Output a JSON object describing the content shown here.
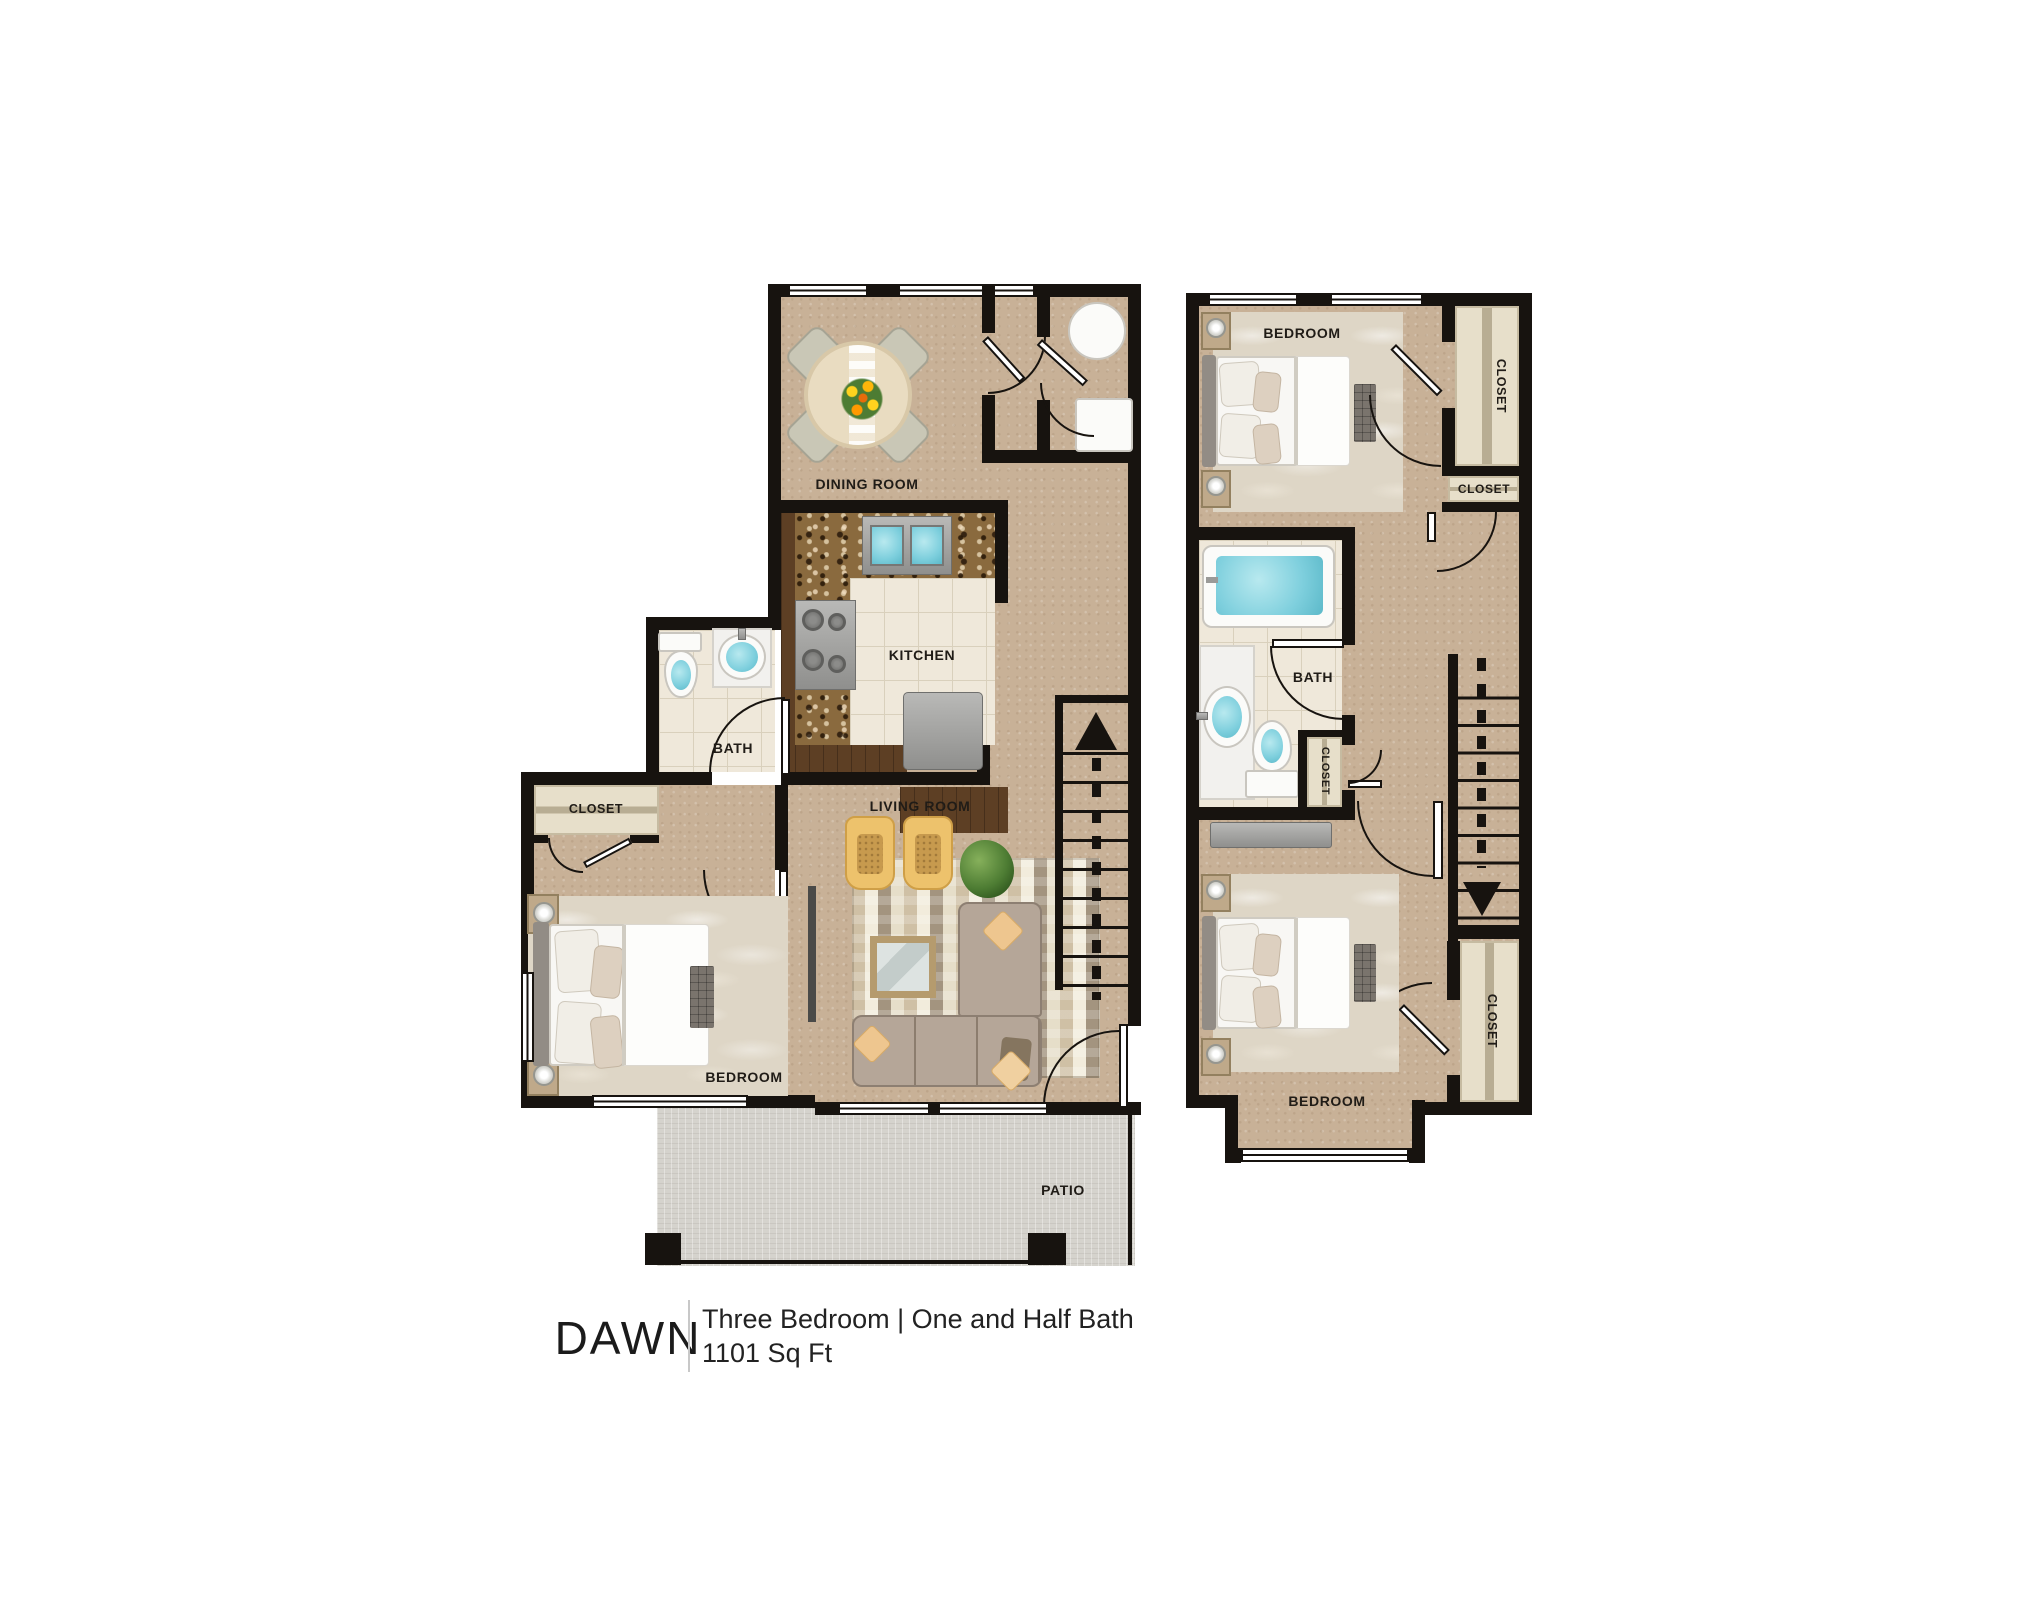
{
  "footer": {
    "name": "DAWN",
    "description": "Three Bedroom | One and Half Bath",
    "area": "1101 Sq Ft"
  },
  "floor1": {
    "dining_room": "DINING ROOM",
    "kitchen": "KITCHEN",
    "bath": "BATH",
    "closet": "CLOSET",
    "bedroom": "BEDROOM",
    "living_room": "LIVING ROOM",
    "patio": "PATIO"
  },
  "floor2": {
    "bedroom_top": "BEDROOM",
    "closet_top": "CLOSET",
    "closet_mid": "CLOSET",
    "bath": "BATH",
    "closet_bath": "CLOSET",
    "bedroom_bottom": "BEDROOM",
    "closet_bottom": "CLOSET"
  },
  "colors": {
    "wall": "#17130f",
    "floor": "#c8b197",
    "carpet": "#ded6c6",
    "tile": "#efe8da",
    "patio": "#d5d3cd",
    "water": "#7ecfdd",
    "sofa": "#b5a698",
    "chair": "#edc26c",
    "granite": "#8a6a3e",
    "wood": "#5d3f24",
    "strip": "#e7dfca"
  }
}
